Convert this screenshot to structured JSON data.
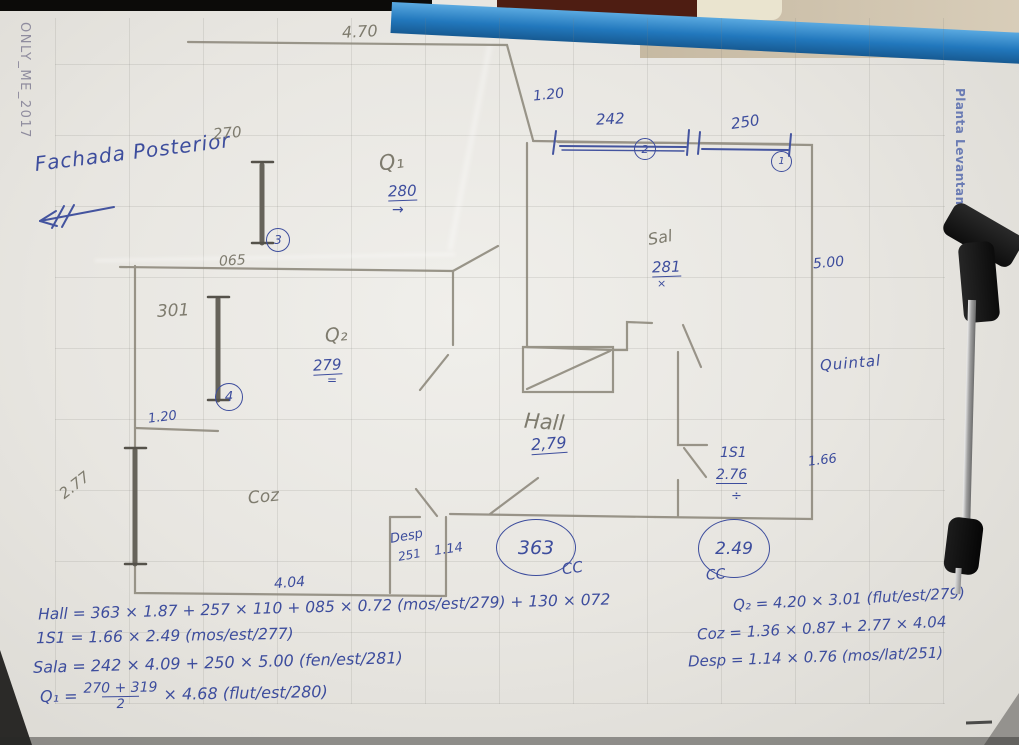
{
  "watermarks": {
    "left": "ONLY_ME_2017",
    "right": "Planta Levantamento"
  },
  "annotations": {
    "facade": "Fachada Posterior",
    "pencil": {
      "d470": "4.70",
      "d270": "270",
      "q1": "Q₁",
      "d065": "065",
      "d301": "301",
      "q2": "Q₂",
      "d277": "2.77",
      "coz": "Coz",
      "hall": "Hall",
      "sala": "Sal"
    },
    "pen": {
      "d120top": "1.20",
      "d242": "242",
      "d250": "250",
      "tag1": "1",
      "tag2": "2",
      "tag3": "3",
      "tag4": "4",
      "q1h": "280",
      "q1arrow": "→",
      "q2h": "279",
      "q2mark": "=",
      "d120left": "1.20",
      "salah": "281",
      "salamark": "×",
      "d500": "5.00",
      "quintal": "Quintal",
      "hallh": "2,79",
      "s1": "1S1",
      "s1h": "2.76",
      "s1mark": "÷",
      "d166": "1.66",
      "c363": "363",
      "c249": "2.49",
      "cc1": "CC",
      "cc2": "CC",
      "desp": "Desp",
      "desph": "251",
      "d114": "1.14",
      "d404": "4.04"
    }
  },
  "formulas": {
    "hall": "Hall = 363 × 1.87 + 257 × 110 + 085 × 0.72 (mos/est/279) + 130 × 072",
    "s1": "1S1 = 1.66 × 2.49 (mos/est/277)",
    "sala": "Sala = 242 × 4.09 + 250 × 5.00 (fen/est/281)",
    "q1": {
      "lead": "Q₁ =",
      "num": "270 + 319",
      "den": "2",
      "rest": "× 4.68  (flut/est/280)"
    },
    "q2": "Q₂ = 4.20 × 3.01 (flut/est/279)",
    "coz": "Coz = 1.36 × 0.87 + 2.77 × 4.04",
    "desp": "Desp = 1.14 × 0.76 (mos/lat/251)"
  },
  "colors": {
    "pen": "#3d4d9d",
    "pencil": "#7e7b6e",
    "clipboard_blue": "#2278bd"
  }
}
